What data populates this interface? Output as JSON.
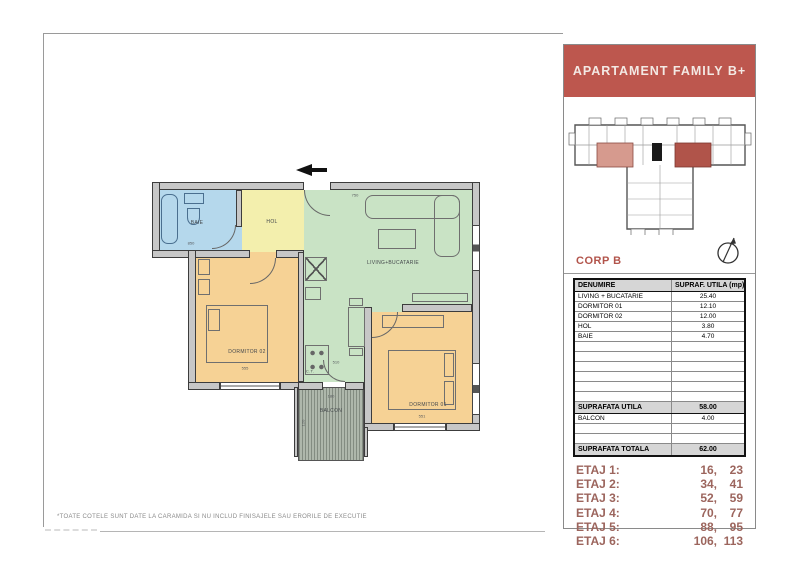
{
  "header": {
    "title": "APARTAMENT FAMILY B+"
  },
  "keyplan": {
    "corp_label": "CORP B"
  },
  "table": {
    "col_name": "DENUMIRE",
    "col_area": "SUPRAF. UTILA (mp)",
    "rows": [
      {
        "name": "LIVING + BUCATARIE",
        "area": "25.40"
      },
      {
        "name": "DORMITOR 01",
        "area": "12.10"
      },
      {
        "name": "DORMITOR 02",
        "area": "12.00"
      },
      {
        "name": "HOL",
        "area": "3.80"
      },
      {
        "name": "BAIE",
        "area": "4.70"
      }
    ],
    "subtotal": {
      "name": "SUPRAFATA UTILA",
      "area": "58.00"
    },
    "balcony_row": {
      "name": "BALCON",
      "area": "4.00"
    },
    "total": {
      "name": "SUPRAFATA TOTALA",
      "area": "62.00"
    }
  },
  "floors": [
    {
      "label": "ETAJ 1:",
      "left": "16,",
      "right": "23"
    },
    {
      "label": "ETAJ 2:",
      "left": "34,",
      "right": "41"
    },
    {
      "label": "ETAJ 3:",
      "left": "52,",
      "right": "59"
    },
    {
      "label": "ETAJ 4:",
      "left": "70,",
      "right": "77"
    },
    {
      "label": "ETAJ 5:",
      "left": "88,",
      "right": "95"
    },
    {
      "label": "ETAJ 6:",
      "left": "106,",
      "right": "113"
    }
  ],
  "plan": {
    "rooms": [
      {
        "id": "baie",
        "label": "BAIE"
      },
      {
        "id": "hol",
        "label": "HOL"
      },
      {
        "id": "living",
        "label": "LIVING+BUCATARIE"
      },
      {
        "id": "dormitor02",
        "label": "DORMITOR 02"
      },
      {
        "id": "dormitor01",
        "label": "DORMITOR 01"
      },
      {
        "id": "balcon",
        "label": "BALCON"
      },
      {
        "id": "centrala",
        "label": "C.T."
      }
    ],
    "dimensions": [
      "750",
      "850",
      "555",
      "510",
      "551",
      "180",
      "120"
    ]
  },
  "footnote": "*TOATE COTELE SUNT DATE LA CARAMIDA SI NU INCLUD FINISAJELE SAU ERORILE DE EXECUTIE",
  "colors": {
    "header_bg": "#bd574e",
    "floors_text": "#9c655d",
    "corp_text": "#b2544b",
    "baie": "#b5d8ec",
    "hol": "#f3efad",
    "living": "#c9e3c5",
    "dormitor": "#f6d295",
    "balcon": "#aeb7ab",
    "wall": "#c7c7c7",
    "keyplan_highlight_left": "#d69a8e",
    "keyplan_highlight_right": "#b0544a"
  }
}
